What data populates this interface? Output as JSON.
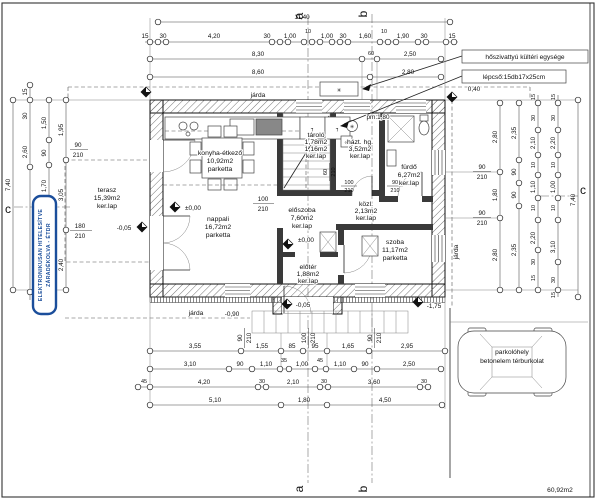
{
  "stamp": {
    "line1": "ELEKTRONIKUSAN HITELESÍTVE",
    "line2": "ZÁRADÉKOLVA - ÉTDR"
  },
  "callouts": {
    "heat_pump": "hőszivattyú kültéri egysége",
    "stair_spec": "lépcső:15db17x25cm",
    "parking_line1": "parkolóhely",
    "parking_line2": "betonelem térburkolat",
    "sidewalk": "járda",
    "parapet": "pm:1,80",
    "offset": "0,40",
    "total_area": "60,92m2"
  },
  "sections": {
    "a": "a",
    "b": "b",
    "c": "c"
  },
  "levels": {
    "zero": "±0,00",
    "m05": "-0,05",
    "m90": "-0,90",
    "m175": "-1,75"
  },
  "rooms": [
    {
      "name": "terasz",
      "area": "15,39m2",
      "floor": "ker.lap"
    },
    {
      "name": "konyha-étkező",
      "area": "10,92m2",
      "floor": "parketta"
    },
    {
      "name": "nappali",
      "area": "16,72m2",
      "floor": "parketta"
    },
    {
      "name": "előszoba",
      "area": "7,60m2",
      "floor": "ker.lap"
    },
    {
      "name": "tároló",
      "area": "1,78m2",
      "area2": "1,16m2",
      "floor": "ker.lap"
    },
    {
      "name": "házt. hg.",
      "area": "3,52m2",
      "floor": "ker.lap"
    },
    {
      "name": "közl.",
      "area": "2,13m2",
      "floor": "ker.lap"
    },
    {
      "name": "fürdő",
      "area": "6,27m2",
      "floor": "ker.lap"
    },
    {
      "name": "szoba",
      "area": "11,17m2",
      "floor": "parketta"
    },
    {
      "name": "előtér",
      "area": "1,88m2",
      "floor": "ker.lap"
    }
  ],
  "openings": {
    "d90": {
      "w": "90",
      "h": "210"
    },
    "d100": {
      "w": "100",
      "h": "210"
    },
    "d180": {
      "w": "180",
      "h": "210"
    },
    "d60": {
      "w": "60",
      "h": "210"
    }
  },
  "dims": {
    "top_total": "11,40",
    "top_detail": [
      "15",
      "30",
      "4,20",
      "30",
      "1,00",
      "10",
      "1,00",
      "30",
      "1,60",
      "10",
      "1,90",
      "30",
      "15"
    ],
    "top_mid": [
      "8,30",
      "60",
      "2,50"
    ],
    "top_outer": [
      "8,60",
      "2,80"
    ],
    "bottom_r1": [
      "3,55",
      "1,55",
      "85",
      "95",
      "1,65",
      "2,95"
    ],
    "bottom_r2": [
      "3,10",
      "90",
      "1,10",
      "35",
      "1,00",
      "45",
      "1,10",
      "90",
      "2,50"
    ],
    "bottom_r3": [
      "45",
      "4,20",
      "30",
      "2,10",
      "30",
      "3,60",
      "30"
    ],
    "bottom_r4": [
      "5,10",
      "1,80",
      "4,50"
    ],
    "left_c1": "7,40",
    "left_c2": [
      "15",
      "30",
      "2,60"
    ],
    "left_c3": [
      "1,50",
      "90",
      "1,70",
      "3,81",
      "30",
      "15"
    ],
    "left_c4": [
      "1,95",
      "3,05",
      "2,40"
    ],
    "right_c1": [
      "2,80",
      "1,80",
      "2,80"
    ],
    "right_c2": [
      "2,35",
      "90",
      "90",
      "2,35"
    ],
    "right_c3": [
      "15",
      "30",
      "2,10",
      "10",
      "1,10",
      "10",
      "2,20",
      "30",
      "15"
    ],
    "right_c4": [
      "15",
      "30",
      "2,20",
      "10",
      "1,00",
      "10",
      "3,10",
      "30",
      "15"
    ],
    "right_c5": "7,40"
  }
}
